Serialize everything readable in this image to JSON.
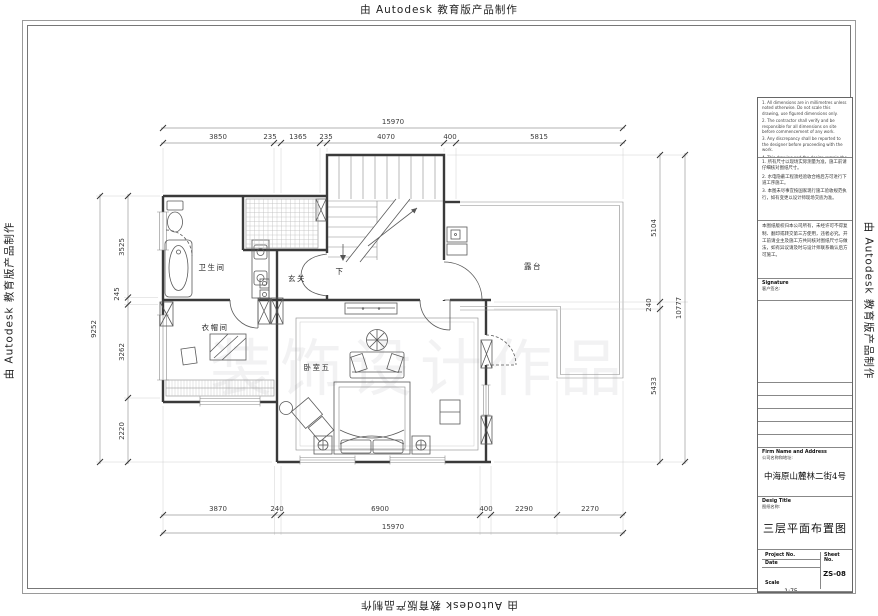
{
  "border": {
    "autodesk_text": "由 Autodesk 教育版产品制作"
  },
  "watermark": {
    "text": "装饰设计作品"
  },
  "plan": {
    "rooms": {
      "bathroom": "卫生间",
      "entry": "玄关",
      "closet": "衣帽间",
      "bedroom": "卧室五",
      "terrace": "露台",
      "stairs_down": "下"
    }
  },
  "dims": {
    "top": {
      "total": "15970",
      "segments": [
        "3850",
        "235",
        "1365",
        "235",
        "4070",
        "400",
        "5815"
      ]
    },
    "bottom": {
      "total": "15970",
      "segments": [
        "3870",
        "240",
        "6900",
        "400",
        "2290",
        "2270"
      ]
    },
    "left": {
      "total": "9252",
      "segments": [
        "3525",
        "245",
        "3262",
        "2220"
      ]
    },
    "right": {
      "outer": "10777",
      "segments": [
        "5104",
        "240",
        "5433"
      ]
    }
  },
  "titleblock": {
    "notes_en": [
      "1. All dimensions are in millimetres unless noted otherwise. Do not scale this drawing, use figured dimensions only.",
      "2. The contractor shall verify and be responsible for all dimensions on site before commencement of any work.",
      "3. Any discrepancy shall be reported to the designer before proceeding with the work.",
      "4. This drawing and the design remain the property of the design firm and may not be reproduced without written consent."
    ],
    "notes_cn": [
      "1. 所有尺寸以现场实际测量为准，施工前请仔细核对图纸尺寸。",
      "2. 水电隐蔽工程须经验收合格后方可进行下道工序施工。",
      "3. 本图未尽事宜按国家现行施工验收规范执行，如有变更以设计师现场交底为准。"
    ],
    "disclaimer": "本图纸版权归本公司所有，未经许可不得复制、翻印或转交第三方使用，违者必究。开工前请业主及施工方共同核对图纸尺寸与做法，如有异议请及时与设计师联系确认后方可施工。",
    "signature": {
      "label": "Signature",
      "cn": "客户签名:"
    },
    "roles": [
      {
        "en": "Designer",
        "cn": "设计:"
      },
      {
        "en": "Drawnby",
        "cn": "绘图:"
      },
      {
        "en": "Approve",
        "cn": "审核:"
      },
      {
        "en": "Dealer",
        "cn": "经销:"
      },
      {
        "en": "Supervision",
        "cn": "监理:"
      }
    ],
    "firm": {
      "label": "Firm Name and Address",
      "cn": "公司名称和地址:",
      "address": "中海原山麓林二街4号"
    },
    "desig": {
      "label": "Desig Title",
      "cn": "图纸名称:",
      "title": "三层平面布置图"
    },
    "project": {
      "label": "Project No."
    },
    "sheet": {
      "label": "Sheet No.",
      "value": "ZS-08"
    },
    "date": {
      "label": "Date"
    },
    "scale": {
      "label": "Scale",
      "value": "1:75"
    }
  }
}
